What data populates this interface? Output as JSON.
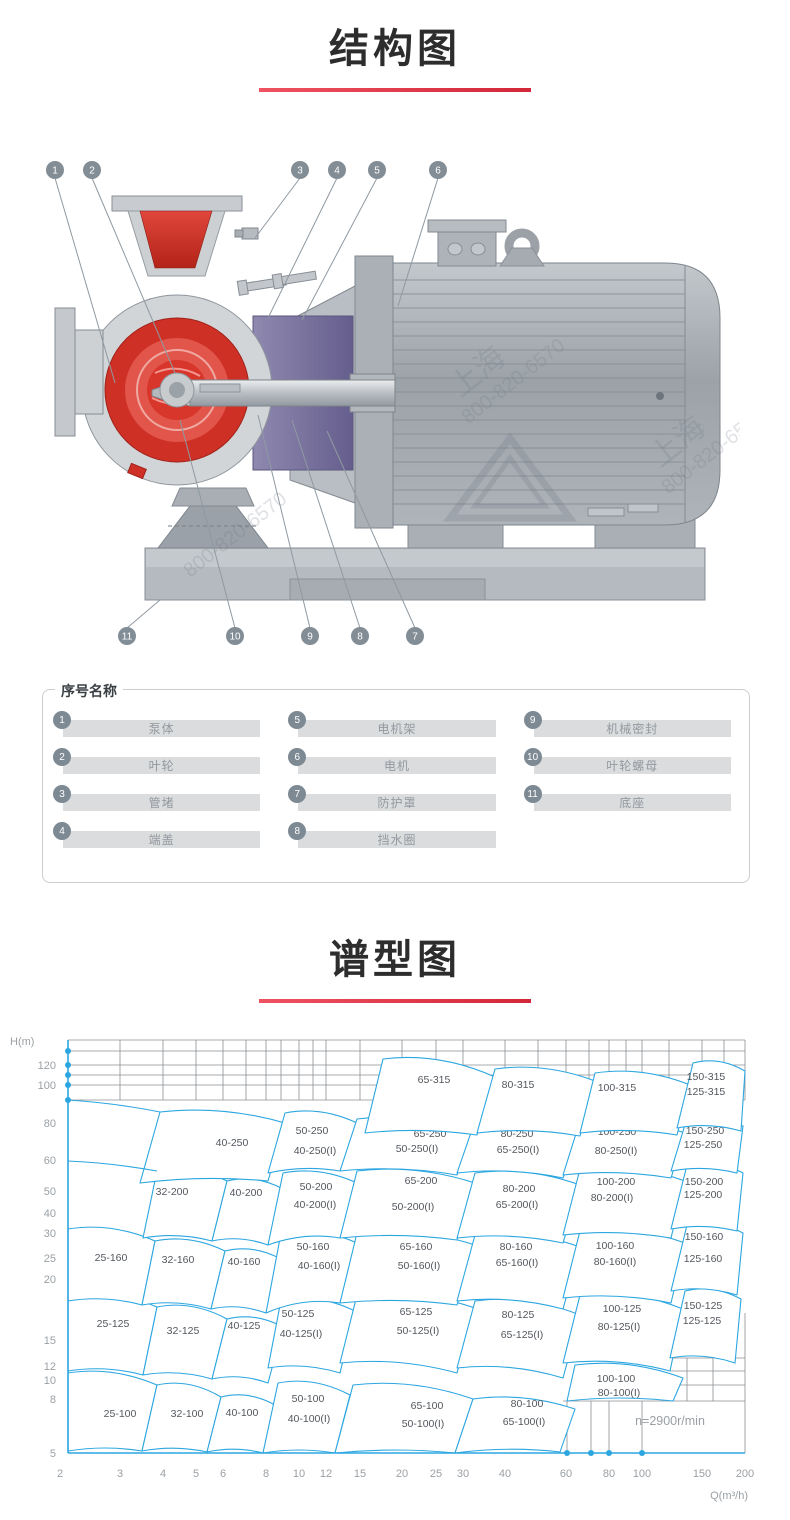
{
  "titles": {
    "structure": "结构图",
    "spectrum": "谱型图"
  },
  "colors": {
    "accent": "#d22738",
    "chart_line": "#2ca6e0",
    "grid": "#8a8f94",
    "legend_circle": "#7d8993",
    "pump_red": "#cf3026",
    "seal_purple": "#716b98",
    "metal_gray": "#b5bac0"
  },
  "diagram": {
    "watermark_name": "上海",
    "watermark_phone": "800-820-6570",
    "callouts": [
      {
        "n": "1",
        "cx": 15,
        "cy": 12,
        "tx": 75,
        "ty": 225
      },
      {
        "n": "2",
        "cx": 52,
        "cy": 12,
        "tx": 135,
        "ty": 215
      },
      {
        "n": "3",
        "cx": 260,
        "cy": 12,
        "tx": 215,
        "ty": 80
      },
      {
        "n": "4",
        "cx": 297,
        "cy": 12,
        "tx": 228,
        "ty": 160
      },
      {
        "n": "5",
        "cx": 337,
        "cy": 12,
        "tx": 262,
        "ty": 162
      },
      {
        "n": "6",
        "cx": 398,
        "cy": 12,
        "tx": 358,
        "ty": 148
      },
      {
        "n": "7",
        "cx": 375,
        "cy": 478,
        "tx": 287,
        "ty": 273
      },
      {
        "n": "8",
        "cx": 320,
        "cy": 478,
        "tx": 252,
        "ty": 262
      },
      {
        "n": "9",
        "cx": 270,
        "cy": 478,
        "tx": 218,
        "ty": 257
      },
      {
        "n": "10",
        "cx": 195,
        "cy": 478,
        "tx": 140,
        "ty": 262
      },
      {
        "n": "11",
        "cx": 87,
        "cy": 478,
        "tx": 120,
        "ty": 442
      }
    ]
  },
  "legend": {
    "title": "序号名称",
    "columns": [
      [
        {
          "n": "1",
          "label": "泵体"
        },
        {
          "n": "2",
          "label": "叶轮"
        },
        {
          "n": "3",
          "label": "管堵"
        },
        {
          "n": "4",
          "label": "端盖"
        }
      ],
      [
        {
          "n": "5",
          "label": "电机架"
        },
        {
          "n": "6",
          "label": "电机"
        },
        {
          "n": "7",
          "label": "防护罩"
        },
        {
          "n": "8",
          "label": "挡水圈"
        }
      ],
      [
        {
          "n": "9",
          "label": "机械密封"
        },
        {
          "n": "10",
          "label": "叶轮螺母"
        },
        {
          "n": "11",
          "label": "底座"
        }
      ]
    ]
  },
  "chart_data": {
    "type": "region-map",
    "title": "谱型图",
    "xlabel": "Q(m³/h)",
    "ylabel": "H(m)",
    "x_range": [
      2,
      200
    ],
    "y_range": [
      5,
      140
    ],
    "log_log": true,
    "annotation": "n=2900r/min",
    "x_ticks": [
      {
        "v": "2",
        "x": 50
      },
      {
        "v": "3",
        "x": 110
      },
      {
        "v": "4",
        "x": 153
      },
      {
        "v": "5",
        "x": 186
      },
      {
        "v": "6",
        "x": 213
      },
      {
        "v": "8",
        "x": 256
      },
      {
        "v": "10",
        "x": 289
      },
      {
        "v": "12",
        "x": 316
      },
      {
        "v": "15",
        "x": 350
      },
      {
        "v": "20",
        "x": 392
      },
      {
        "v": "25",
        "x": 426
      },
      {
        "v": "30",
        "x": 453
      },
      {
        "v": "40",
        "x": 495
      },
      {
        "v": "60",
        "x": 556
      },
      {
        "v": "80",
        "x": 599
      },
      {
        "v": "100",
        "x": 632
      },
      {
        "v": "150",
        "x": 692
      },
      {
        "v": "200",
        "x": 735
      }
    ],
    "y_ticks": [
      {
        "v": "120",
        "y": 32
      },
      {
        "v": "100",
        "y": 52
      },
      {
        "v": "80",
        "y": 90
      },
      {
        "v": "60",
        "y": 127
      },
      {
        "v": "50",
        "y": 158
      },
      {
        "v": "40",
        "y": 180
      },
      {
        "v": "30",
        "y": 200
      },
      {
        "v": "25",
        "y": 225
      },
      {
        "v": "20",
        "y": 246
      },
      {
        "v": "15",
        "y": 307
      },
      {
        "v": "12",
        "y": 333
      },
      {
        "v": "10",
        "y": 347
      },
      {
        "v": "8",
        "y": 366
      },
      {
        "v": "5",
        "y": 420
      }
    ],
    "regions": [
      {
        "quad": [
          58,
          418,
          58,
          340,
          147,
          352,
          132,
          418
        ],
        "labels": [
          [
            "25-100",
            110,
            381
          ]
        ]
      },
      {
        "quad": [
          132,
          418,
          147,
          352,
          211,
          364,
          197,
          419
        ],
        "labels": [
          [
            "32-100",
            177,
            381
          ]
        ]
      },
      {
        "quad": [
          197,
          419,
          211,
          364,
          265,
          372,
          253,
          420
        ],
        "labels": [
          [
            "40-100",
            232,
            380
          ]
        ]
      },
      {
        "quad": [
          253,
          420,
          268,
          350,
          340,
          362,
          325,
          420
        ],
        "labels": [
          [
            "50-100",
            298,
            366
          ],
          [
            "40-100(I)",
            299,
            386
          ]
        ]
      },
      {
        "quad": [
          325,
          420,
          343,
          352,
          463,
          366,
          445,
          420
        ],
        "labels": [
          [
            "65-100",
            417,
            373
          ],
          [
            "50-100(I)",
            413,
            391
          ]
        ]
      },
      {
        "quad": [
          445,
          420,
          463,
          366,
          565,
          376,
          550,
          419
        ],
        "labels": [
          [
            "80-100",
            517,
            371
          ],
          [
            "65-100(I)",
            514,
            389
          ]
        ]
      },
      {
        "quad": [
          557,
          368,
          565,
          332,
          673,
          345,
          663,
          368
        ],
        "labels": [
          [
            "100-100",
            606,
            346
          ],
          [
            "80-100(I)",
            609,
            360
          ]
        ]
      },
      {
        "quad": [
          58,
          338,
          58,
          262,
          147,
          274,
          133,
          342
        ],
        "labels": [
          [
            "25-125",
            103,
            291
          ]
        ]
      },
      {
        "quad": [
          133,
          342,
          147,
          274,
          217,
          286,
          202,
          346
        ],
        "labels": [
          [
            "32-125",
            173,
            298
          ]
        ]
      },
      {
        "quad": [
          202,
          346,
          217,
          286,
          273,
          294,
          258,
          350
        ],
        "labels": [
          [
            "40-125",
            234,
            293
          ]
        ]
      },
      {
        "quad": [
          258,
          335,
          271,
          267,
          345,
          278,
          330,
          340
        ],
        "labels": [
          [
            "50-125",
            288,
            281
          ],
          [
            "40-125(I)",
            291,
            301
          ]
        ]
      },
      {
        "quad": [
          330,
          330,
          347,
          262,
          465,
          275,
          447,
          340
        ],
        "labels": [
          [
            "65-125",
            406,
            279
          ],
          [
            "50-125(I)",
            408,
            298
          ]
        ]
      },
      {
        "quad": [
          447,
          335,
          465,
          268,
          570,
          282,
          553,
          345
        ],
        "labels": [
          [
            "80-125",
            508,
            282
          ],
          [
            "65-125(I)",
            512,
            302
          ]
        ]
      },
      {
        "quad": [
          553,
          330,
          570,
          262,
          673,
          276,
          660,
          338
        ],
        "labels": [
          [
            "100-125",
            612,
            276
          ],
          [
            "80-125(I)",
            609,
            294
          ]
        ]
      },
      {
        "quad": [
          660,
          325,
          675,
          258,
          731,
          266,
          725,
          330
        ],
        "labels": [
          [
            "150-125",
            693,
            273
          ],
          [
            "125-125",
            692,
            288
          ]
        ]
      },
      {
        "quad": [
          58,
          268,
          58,
          196,
          145,
          208,
          132,
          272
        ],
        "labels": [
          [
            "25-160",
            101,
            225
          ]
        ]
      },
      {
        "quad": [
          132,
          272,
          145,
          208,
          215,
          218,
          201,
          276
        ],
        "labels": [
          [
            "32-160",
            168,
            227
          ]
        ]
      },
      {
        "quad": [
          201,
          276,
          215,
          218,
          271,
          226,
          256,
          280
        ],
        "labels": [
          [
            "40-160",
            234,
            229
          ]
        ]
      },
      {
        "quad": [
          256,
          280,
          271,
          200,
          347,
          210,
          330,
          270
        ],
        "labels": [
          [
            "50-160",
            303,
            214
          ],
          [
            "40-160(I)",
            309,
            233
          ]
        ]
      },
      {
        "quad": [
          330,
          270,
          347,
          200,
          465,
          212,
          447,
          272
        ],
        "labels": [
          [
            "65-160",
            406,
            214
          ],
          [
            "50-160(I)",
            409,
            233
          ]
        ]
      },
      {
        "quad": [
          447,
          268,
          465,
          202,
          570,
          214,
          553,
          276
        ],
        "labels": [
          [
            "80-160",
            506,
            214
          ],
          [
            "65-160(I)",
            507,
            230
          ]
        ]
      },
      {
        "quad": [
          553,
          265,
          570,
          198,
          675,
          210,
          661,
          270
        ],
        "labels": [
          [
            "100-160",
            605,
            213
          ],
          [
            "80-160(I)",
            605,
            229
          ]
        ]
      },
      {
        "quad": [
          661,
          258,
          677,
          192,
          733,
          200,
          727,
          262
        ],
        "labels": [
          [
            "150-160",
            694,
            204
          ],
          [
            "125-160",
            693,
            226
          ]
        ]
      },
      {
        "quad": [
          133,
          205,
          147,
          138,
          217,
          148,
          202,
          208
        ],
        "labels": [
          [
            "32-200",
            162,
            159
          ]
        ]
      },
      {
        "quad": [
          202,
          208,
          217,
          148,
          273,
          156,
          258,
          212
        ],
        "labels": [
          [
            "40-200",
            236,
            160
          ]
        ]
      },
      {
        "quad": [
          258,
          212,
          273,
          140,
          347,
          150,
          330,
          205
        ],
        "labels": [
          [
            "50-200",
            306,
            154
          ],
          [
            "40-200(I)",
            305,
            172
          ]
        ]
      },
      {
        "quad": [
          330,
          205,
          347,
          138,
          465,
          150,
          447,
          207
        ],
        "labels": [
          [
            "65-200",
            411,
            148
          ],
          [
            "50-200(I)",
            403,
            174
          ]
        ]
      },
      {
        "quad": [
          447,
          205,
          465,
          140,
          570,
          152,
          553,
          210
        ],
        "labels": [
          [
            "80-200",
            509,
            156
          ],
          [
            "65-200(I)",
            507,
            172
          ]
        ]
      },
      {
        "quad": [
          553,
          202,
          570,
          136,
          675,
          148,
          661,
          205
        ],
        "labels": [
          [
            "100-200",
            606,
            149
          ],
          [
            "80-200(I)",
            602,
            165
          ]
        ]
      },
      {
        "quad": [
          661,
          196,
          677,
          132,
          733,
          140,
          727,
          198
        ],
        "labels": [
          [
            "150-200",
            694,
            149
          ],
          [
            "125-200",
            693,
            162
          ]
        ]
      },
      {
        "quad": [
          130,
          150,
          150,
          79,
          275,
          90,
          258,
          148
        ],
        "labels": [
          [
            "40-250",
            222,
            110
          ]
        ]
      },
      {
        "quad": [
          258,
          140,
          275,
          80,
          347,
          90,
          330,
          138
        ],
        "labels": [
          [
            "50-250",
            302,
            98
          ],
          [
            "40-250(I)",
            305,
            118
          ]
        ]
      },
      {
        "quad": [
          330,
          138,
          347,
          86,
          465,
          98,
          447,
          142
        ],
        "labels": [
          [
            "65-250",
            420,
            101
          ],
          [
            "50-250(I)",
            407,
            116
          ]
        ]
      },
      {
        "quad": [
          447,
          140,
          465,
          88,
          570,
          100,
          553,
          145
        ],
        "labels": [
          [
            "80-250",
            507,
            101
          ],
          [
            "65-250(I)",
            508,
            117
          ]
        ]
      },
      {
        "quad": [
          553,
          142,
          570,
          88,
          675,
          100,
          661,
          145
        ],
        "labels": [
          [
            "100-250",
            607,
            99
          ],
          [
            "80-250(I)",
            606,
            118
          ]
        ]
      },
      {
        "quad": [
          661,
          138,
          677,
          85,
          733,
          93,
          727,
          140
        ],
        "labels": [
          [
            "150-250",
            695,
            98
          ],
          [
            "125-250",
            693,
            112
          ]
        ]
      },
      {
        "quad": [
          355,
          100,
          373,
          26,
          485,
          44,
          467,
          102
        ],
        "labels": [
          [
            "65-315",
            424,
            47
          ]
        ]
      },
      {
        "quad": [
          467,
          100,
          485,
          36,
          585,
          48,
          570,
          103
        ],
        "labels": [
          [
            "80-315",
            508,
            52
          ]
        ]
      },
      {
        "quad": [
          570,
          100,
          585,
          40,
          680,
          52,
          667,
          102
        ],
        "labels": [
          [
            "100-315",
            607,
            55
          ]
        ]
      },
      {
        "quad": [
          667,
          95,
          683,
          30,
          735,
          38,
          731,
          98
        ],
        "labels": [
          [
            "150-315",
            696,
            44
          ],
          [
            "125-315",
            696,
            59
          ]
        ]
      }
    ],
    "axis_curves": [
      [
        58,
        67,
        105,
        70,
        150,
        79
      ],
      [
        58,
        128,
        103,
        130,
        147,
        138
      ]
    ],
    "left_dots_y": [
      18,
      32,
      42,
      52,
      67
    ],
    "bottom_dots_x": [
      557,
      581,
      599,
      632
    ],
    "grid": {
      "top_h_y": [
        7,
        18,
        32,
        42,
        52,
        67
      ],
      "top_v_x": [
        110,
        153,
        186,
        213,
        236,
        256,
        271,
        289,
        303,
        316,
        350,
        392,
        426,
        453,
        495,
        528,
        556,
        579,
        599,
        616,
        632,
        659,
        692,
        714,
        735
      ],
      "br_v_x": [
        557,
        581,
        599,
        632
      ],
      "br_h_y": [
        325,
        338,
        352
      ],
      "annotation_pos": [
        660,
        392
      ]
    }
  }
}
